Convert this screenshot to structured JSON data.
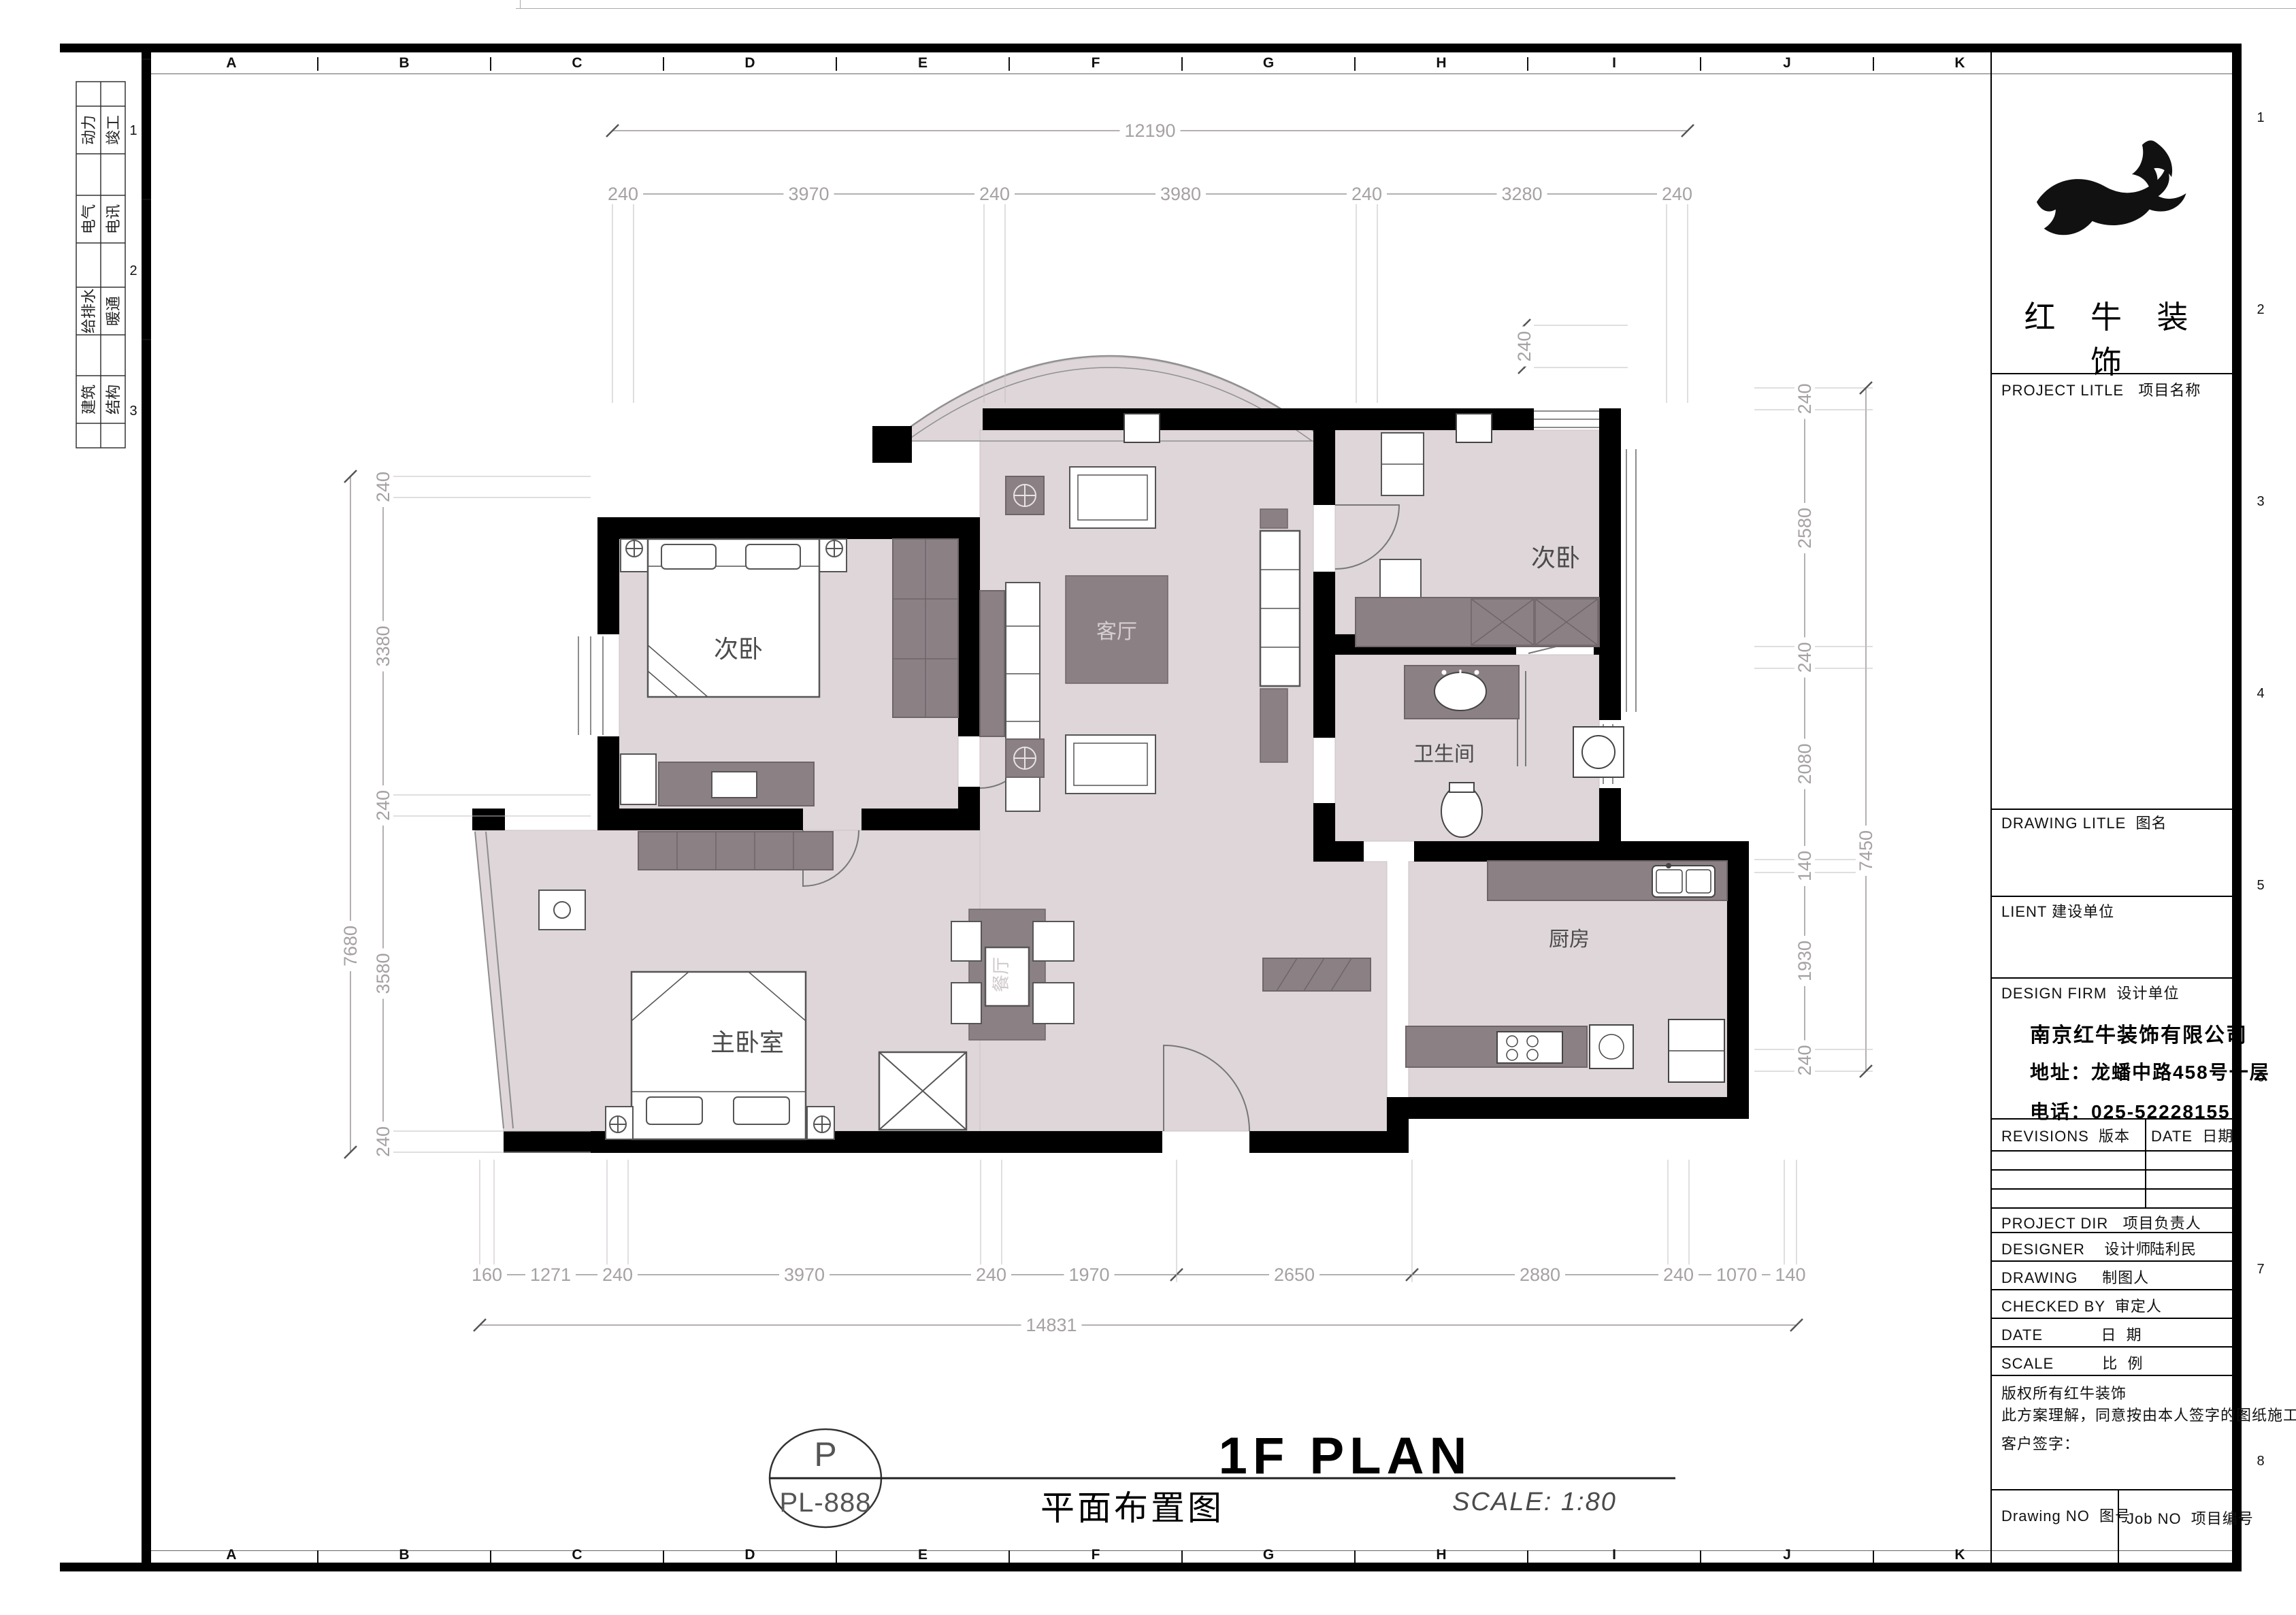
{
  "colors": {
    "wall": "#000000",
    "floor": "#ded6d9",
    "furniture_dark": "#8b8185",
    "dim_text": "#a6a1a4",
    "accent_logo": "#111111"
  },
  "grid": {
    "letters": [
      "A",
      "B",
      "C",
      "D",
      "E",
      "F",
      "G",
      "H",
      "I",
      "J",
      "K"
    ],
    "left_numbers": [
      "1",
      "2",
      "3"
    ],
    "right_numbers": [
      "1",
      "2",
      "3",
      "4",
      "5",
      "6",
      "7",
      "8"
    ]
  },
  "margin_tabs": [
    {
      "left": "动力",
      "right": "竣工"
    },
    {
      "left": "电气",
      "right": "电讯"
    },
    {
      "left": "给排水",
      "right": "暖通"
    },
    {
      "left": "建筑",
      "right": "结构"
    }
  ],
  "dimensions": {
    "top": {
      "total": "12190",
      "segments": [
        "240",
        "3970",
        "240",
        "3980",
        "240",
        "3280",
        "240"
      ]
    },
    "bottom": {
      "total": "14831",
      "segments": [
        "160",
        "1271",
        "240",
        "3970",
        "240",
        "1970",
        "2650",
        "2880",
        "240",
        "1070",
        "140"
      ]
    },
    "left": {
      "total": "7680",
      "segments": [
        "240",
        "3380",
        "240",
        "3580",
        "240"
      ]
    },
    "right": {
      "total": "7450",
      "segments": [
        "240",
        "2580",
        "240",
        "2080",
        "140",
        "1930",
        "240"
      ]
    },
    "extra": {
      "window_offset": "240"
    }
  },
  "rooms": {
    "bedroom_left": "次卧",
    "bedroom_right": "次卧",
    "master_bedroom": "主卧室",
    "living": "客厅",
    "dining": "餐厅",
    "bathroom": "卫生间",
    "kitchen": "厨房"
  },
  "title_block": {
    "logo_name": "红 牛 装 饰",
    "project_label": "PROJECT LITLE   项目名称",
    "drawing_label": "DRAWING LITLE  图名",
    "client_label": "LIENT 建设单位",
    "design_firm_label": "DESIGN FIRM  设计单位",
    "company": "南京红牛装饰有限公司",
    "address": "地址：龙蟠中路458号一层",
    "phone": "电话：025-52228155",
    "revisions_label": "REVISIONS  版本",
    "date_col_label": "DATE  日期",
    "project_dir_label": "PROJECT DIR   项目负责人",
    "designer_label": "DESIGNER    设计师",
    "designer_value": "陆利民",
    "drawing_by_label": "DRAWING     制图人",
    "checked_label": "CHECKED BY  审定人",
    "date_label": "DATE            日  期",
    "scale_label": "SCALE          比  例",
    "copyright_line1": "版权所有红牛装饰",
    "copyright_line2": "此方案理解，同意按由本人签字的图纸施工；",
    "customer_sign": "客户签字：",
    "drawing_no_label": "Drawing NO  图号",
    "job_no_label": "Job NO  项目编号"
  },
  "footer": {
    "detail_letter": "P",
    "detail_code": "PL-888",
    "title_en": "1F PLAN",
    "title_cn": "平面布置图",
    "scale_text": "SCALE: 1:80"
  }
}
